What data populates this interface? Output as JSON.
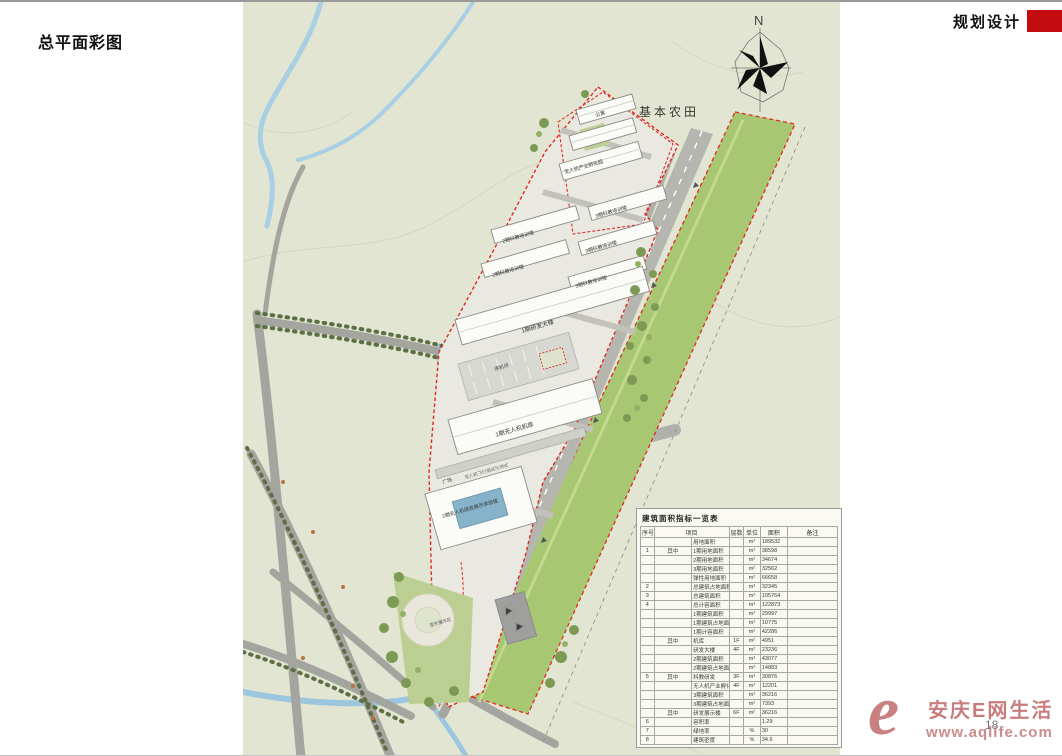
{
  "page": {
    "title": "总平面彩图",
    "header_right": "规划设计",
    "page_number": "18",
    "accent_red": "#c20c10"
  },
  "map": {
    "background_color": "#e2e5d2",
    "runway_green": "#a8c772",
    "boundary_red": "#e02b20",
    "labels": [
      {
        "t": "N",
        "x": 511,
        "y": 12,
        "r": 0,
        "s": 13,
        "c": "#444"
      },
      {
        "t": "基本农田",
        "x": 396,
        "y": 104,
        "r": 0,
        "s": 12,
        "c": "#33362a",
        "ls": 3
      },
      {
        "t": "公寓",
        "x": 352,
        "y": 112,
        "r": -16,
        "s": 5,
        "c": "#333"
      },
      {
        "t": "无人机产业孵化园",
        "x": 321,
        "y": 169,
        "r": -16,
        "s": 5,
        "c": "#333"
      },
      {
        "t": "3期科教培训楼",
        "x": 352,
        "y": 213,
        "r": -16,
        "s": 5,
        "c": "#333"
      },
      {
        "t": "2期科教培训楼",
        "x": 259,
        "y": 238,
        "r": -16,
        "s": 5,
        "c": "#333"
      },
      {
        "t": "3期科教培训楼",
        "x": 342,
        "y": 248,
        "r": -16,
        "s": 5,
        "c": "#333"
      },
      {
        "t": "2期科教培训楼",
        "x": 249,
        "y": 272,
        "r": -16,
        "s": 5,
        "c": "#333"
      },
      {
        "t": "3期科教培训楼",
        "x": 332,
        "y": 283,
        "r": -16,
        "s": 5,
        "c": "#333"
      },
      {
        "t": "1期研发大楼",
        "x": 278,
        "y": 327,
        "r": -16,
        "s": 6,
        "c": "#333"
      },
      {
        "t": "停机坪",
        "x": 251,
        "y": 366,
        "r": -16,
        "s": 5,
        "c": "#444"
      },
      {
        "t": "1期无人机机库",
        "x": 252,
        "y": 431,
        "r": -16,
        "s": 6,
        "c": "#333"
      },
      {
        "t": "无人机飞行调试与测试",
        "x": 221,
        "y": 473,
        "r": -16,
        "s": 4.5,
        "c": "#666"
      },
      {
        "t": "广场",
        "x": 199,
        "y": 479,
        "r": -16,
        "s": 5,
        "c": "#444"
      },
      {
        "t": "2期无人机研发展示体验楼",
        "x": 196,
        "y": 514,
        "r": -16,
        "s": 5,
        "c": "#333",
        "w": 64
      },
      {
        "t": "室外展示区",
        "x": 186,
        "y": 621,
        "r": -16,
        "s": 4.5,
        "c": "#555"
      }
    ]
  },
  "table": {
    "title": "建筑面积指标一览表",
    "headers": [
      "序号",
      "项目",
      "层数",
      "单位",
      "面积",
      "备注"
    ],
    "rows": [
      [
        "",
        "",
        "用地面积",
        "",
        "m²",
        "189532",
        ""
      ],
      [
        "1",
        "其中",
        "1期用地面积",
        "",
        "m²",
        "38598",
        ""
      ],
      [
        "",
        "",
        "2期用地面积",
        "",
        "m²",
        "34674",
        ""
      ],
      [
        "",
        "",
        "3期用地面积",
        "",
        "m²",
        "32562",
        ""
      ],
      [
        "",
        "",
        "弹性用地面积",
        "",
        "m²",
        "66658",
        ""
      ],
      [
        "2",
        "",
        "总建筑占地面积",
        "",
        "m²",
        "32345",
        ""
      ],
      [
        "3",
        "",
        "总建筑面积",
        "",
        "m²",
        "105764",
        ""
      ],
      [
        "4",
        "",
        "总计容面积",
        "",
        "m²",
        "122873",
        ""
      ],
      [
        "",
        "",
        "1期建筑面积",
        "",
        "m²",
        "29997",
        ""
      ],
      [
        "",
        "",
        "1期建筑占地面积",
        "",
        "m²",
        "10775",
        ""
      ],
      [
        "",
        "",
        "1期计容面积",
        "",
        "m²",
        "42286",
        ""
      ],
      [
        "",
        "其中",
        "机库",
        "1F",
        "m²",
        "4951",
        ""
      ],
      [
        "",
        "",
        "研发大楼",
        "4F",
        "m²",
        "23236",
        ""
      ],
      [
        "",
        "",
        "2期建筑面积",
        "",
        "m²",
        "43077",
        ""
      ],
      [
        "",
        "",
        "2期建筑占地面积",
        "",
        "m²",
        "14883",
        ""
      ],
      [
        "5",
        "其中",
        "科教研发",
        "3F",
        "m²",
        "30876",
        ""
      ],
      [
        "",
        "",
        "无人机产业孵化园",
        "4F",
        "m²",
        "12201",
        ""
      ],
      [
        "",
        "",
        "3期建筑面积",
        "",
        "m²",
        "36216",
        ""
      ],
      [
        "",
        "",
        "3期建筑占地面积",
        "",
        "m²",
        "7393",
        ""
      ],
      [
        "",
        "其中",
        "研发展示楼",
        "6F",
        "m²",
        "36216",
        ""
      ],
      [
        "6",
        "",
        "容积率",
        "",
        "",
        "1.29",
        ""
      ],
      [
        "7",
        "",
        "绿地率",
        "",
        "%",
        "30",
        ""
      ],
      [
        "8",
        "",
        "建筑密度",
        "",
        "%",
        "34.6",
        ""
      ]
    ]
  },
  "watermark": {
    "glyph": "e",
    "line1": "安庆E网生活",
    "line2": "www.aqlife.com"
  }
}
